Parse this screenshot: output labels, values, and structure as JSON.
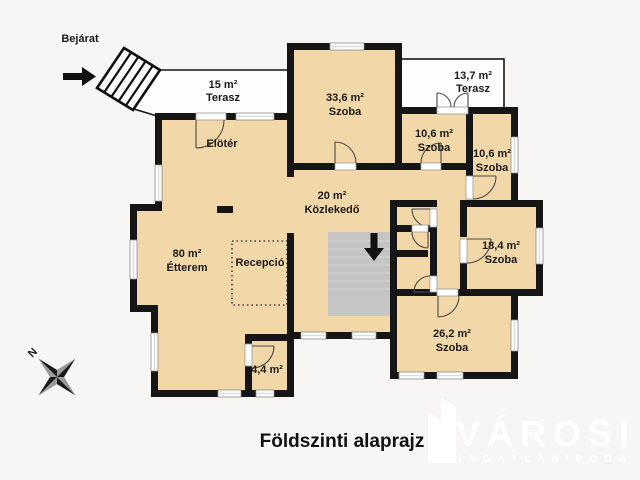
{
  "title": "Földszinti alaprajz",
  "entrance": {
    "label": "Bejárat"
  },
  "compass": {
    "north": "N"
  },
  "watermark": {
    "brand": "VÁROSI",
    "subtitle": "INGATLANIRODA"
  },
  "rooms": {
    "terasz_15": {
      "area": "15 m²",
      "name": "Terasz"
    },
    "szoba_33_6": {
      "area": "33,6 m²",
      "name": "Szoba"
    },
    "terasz_13_7": {
      "area": "13,7 m²",
      "name": "Terasz"
    },
    "szoba_10_6_a": {
      "area": "10,6 m²",
      "name": "Szoba"
    },
    "szoba_10_6_b": {
      "area": "10,6 m²",
      "name": "Szoba"
    },
    "eloter": {
      "name": "Elötér"
    },
    "kozlekedo": {
      "area": "20 m²",
      "name": "Közlekedő"
    },
    "etterem": {
      "area": "80 m²",
      "name": "Étterem"
    },
    "recepcio": {
      "name": "Recepció"
    },
    "szoba_18_4": {
      "area": "18,4 m²",
      "name": "Szoba"
    },
    "szoba_26_2": {
      "area": "26,2 m²",
      "name": "Szoba"
    },
    "helyiseg_4_4": {
      "area": "4,4 m²"
    }
  },
  "colors": {
    "background": "#f7f6f4",
    "room_fill": "#f2d8a9",
    "wall": "#151515",
    "terrace_fill": "#fdfdfd",
    "stairs_fill": "#c5c5c5",
    "watermark": "#ffffff"
  }
}
